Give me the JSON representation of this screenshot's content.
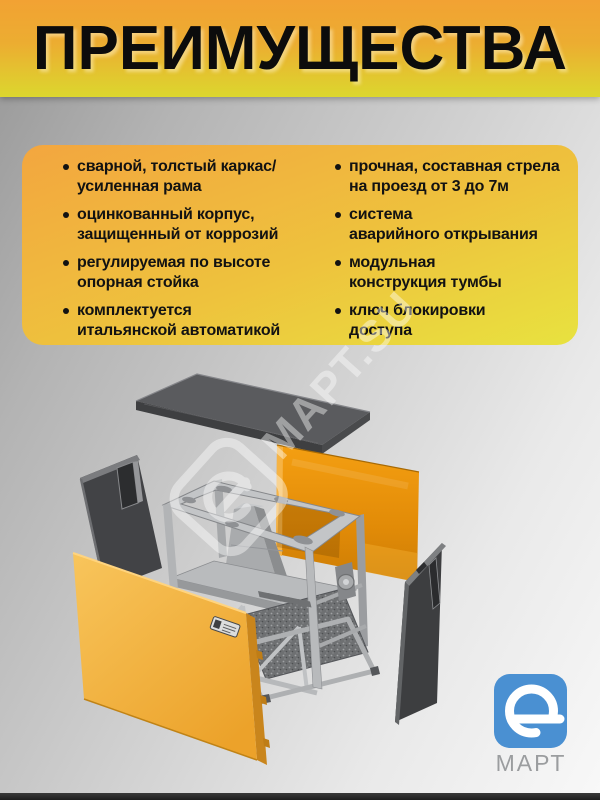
{
  "page": {
    "title": "ПРЕИМУЩЕСТВА"
  },
  "advantages": {
    "left": [
      "сварной, толстый каркас/\nусиленная рама",
      "оцинкованный корпус,\nзащищенный от коррозий",
      "регулируемая по высоте\nопорная стойка",
      "комплектуется\nитальянской автоматикой"
    ],
    "right": [
      "прочная, составная стрела\nна проезд от 3 до 7м",
      "система\nаварийного открывания",
      "модульная\nконструкция тумбы",
      "ключ блокировки\nдоступа"
    ]
  },
  "watermark": {
    "text": "МАРТ.SU"
  },
  "brand": {
    "name": "МАРТ"
  },
  "colors": {
    "banner_top": "#f2a233",
    "banner_bottom": "#dcd72e",
    "card_top": "#f3a63f",
    "card_bottom": "#e8e23f",
    "logo_blue": "#4a90d2",
    "logo_text_gray": "#9b9d9f",
    "panel_orange": "#e88d08",
    "panel_yellow": "#f2b143",
    "panel_dark": "#3d3e40",
    "frame_gray": "#c3c5c7"
  }
}
